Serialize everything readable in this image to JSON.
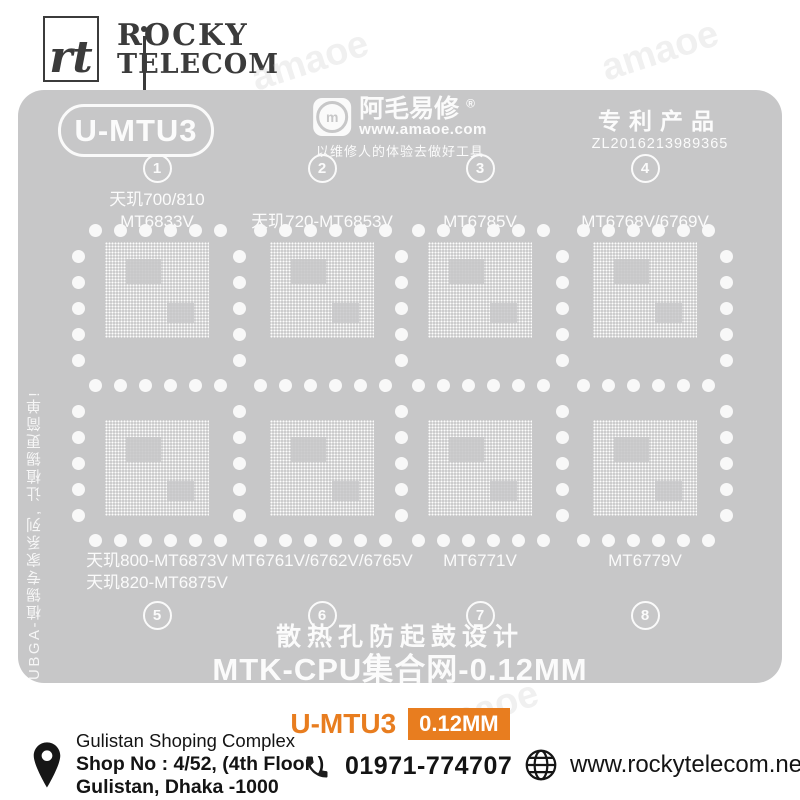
{
  "brand": {
    "monogram": "rt",
    "name_line1": "ROCKY",
    "name_line2": "TELECOM"
  },
  "decor": {
    "watermark": "amaoe"
  },
  "stencil": {
    "model_badge": "U-MTU3",
    "maker": {
      "name": "阿毛易修",
      "registered": "®",
      "icon_letter": "m",
      "website": "www.amaoe.com",
      "slogan": "以维修人的体验去做好工具"
    },
    "patent": {
      "title": "专利产品",
      "number": "ZL2016213989365"
    },
    "side_note": "UBGA-植锡专家系列, 让植锡更简单!",
    "cells": [
      {
        "num": "1",
        "label_lines": [
          "天玑700/810",
          "MT6833V"
        ]
      },
      {
        "num": "2",
        "label_lines": [
          "天玑720-MT6853V"
        ]
      },
      {
        "num": "3",
        "label_lines": [
          "MT6785V"
        ]
      },
      {
        "num": "4",
        "label_lines": [
          "MT6768V/6769V"
        ]
      },
      {
        "num": "5",
        "label_lines": [
          "天玑800-MT6873V",
          "天玑820-MT6875V"
        ]
      },
      {
        "num": "6",
        "label_lines": [
          "MT6761V/6762V/6765V"
        ]
      },
      {
        "num": "7",
        "label_lines": [
          "MT6771V"
        ]
      },
      {
        "num": "8",
        "label_lines": [
          "MT6779V"
        ]
      }
    ],
    "footer_line1": "散热孔防起鼓设计",
    "footer_line2": "MTK-CPU集合网-0.12MM"
  },
  "product": {
    "model": "U-MTU3",
    "thickness": "0.12MM"
  },
  "contact": {
    "address_line1": "Gulistan Shoping Complex",
    "address_line2": "Shop No : 4/52, (4th Floor )",
    "address_line3": "Gulistan, Dhaka -1000",
    "phone": "01971-774707",
    "website": "www.rockytelecom.net"
  },
  "colors": {
    "plate_gray": "#c7c7c8",
    "accent_orange": "#e87d1f",
    "ink": "#3b3b3b"
  }
}
